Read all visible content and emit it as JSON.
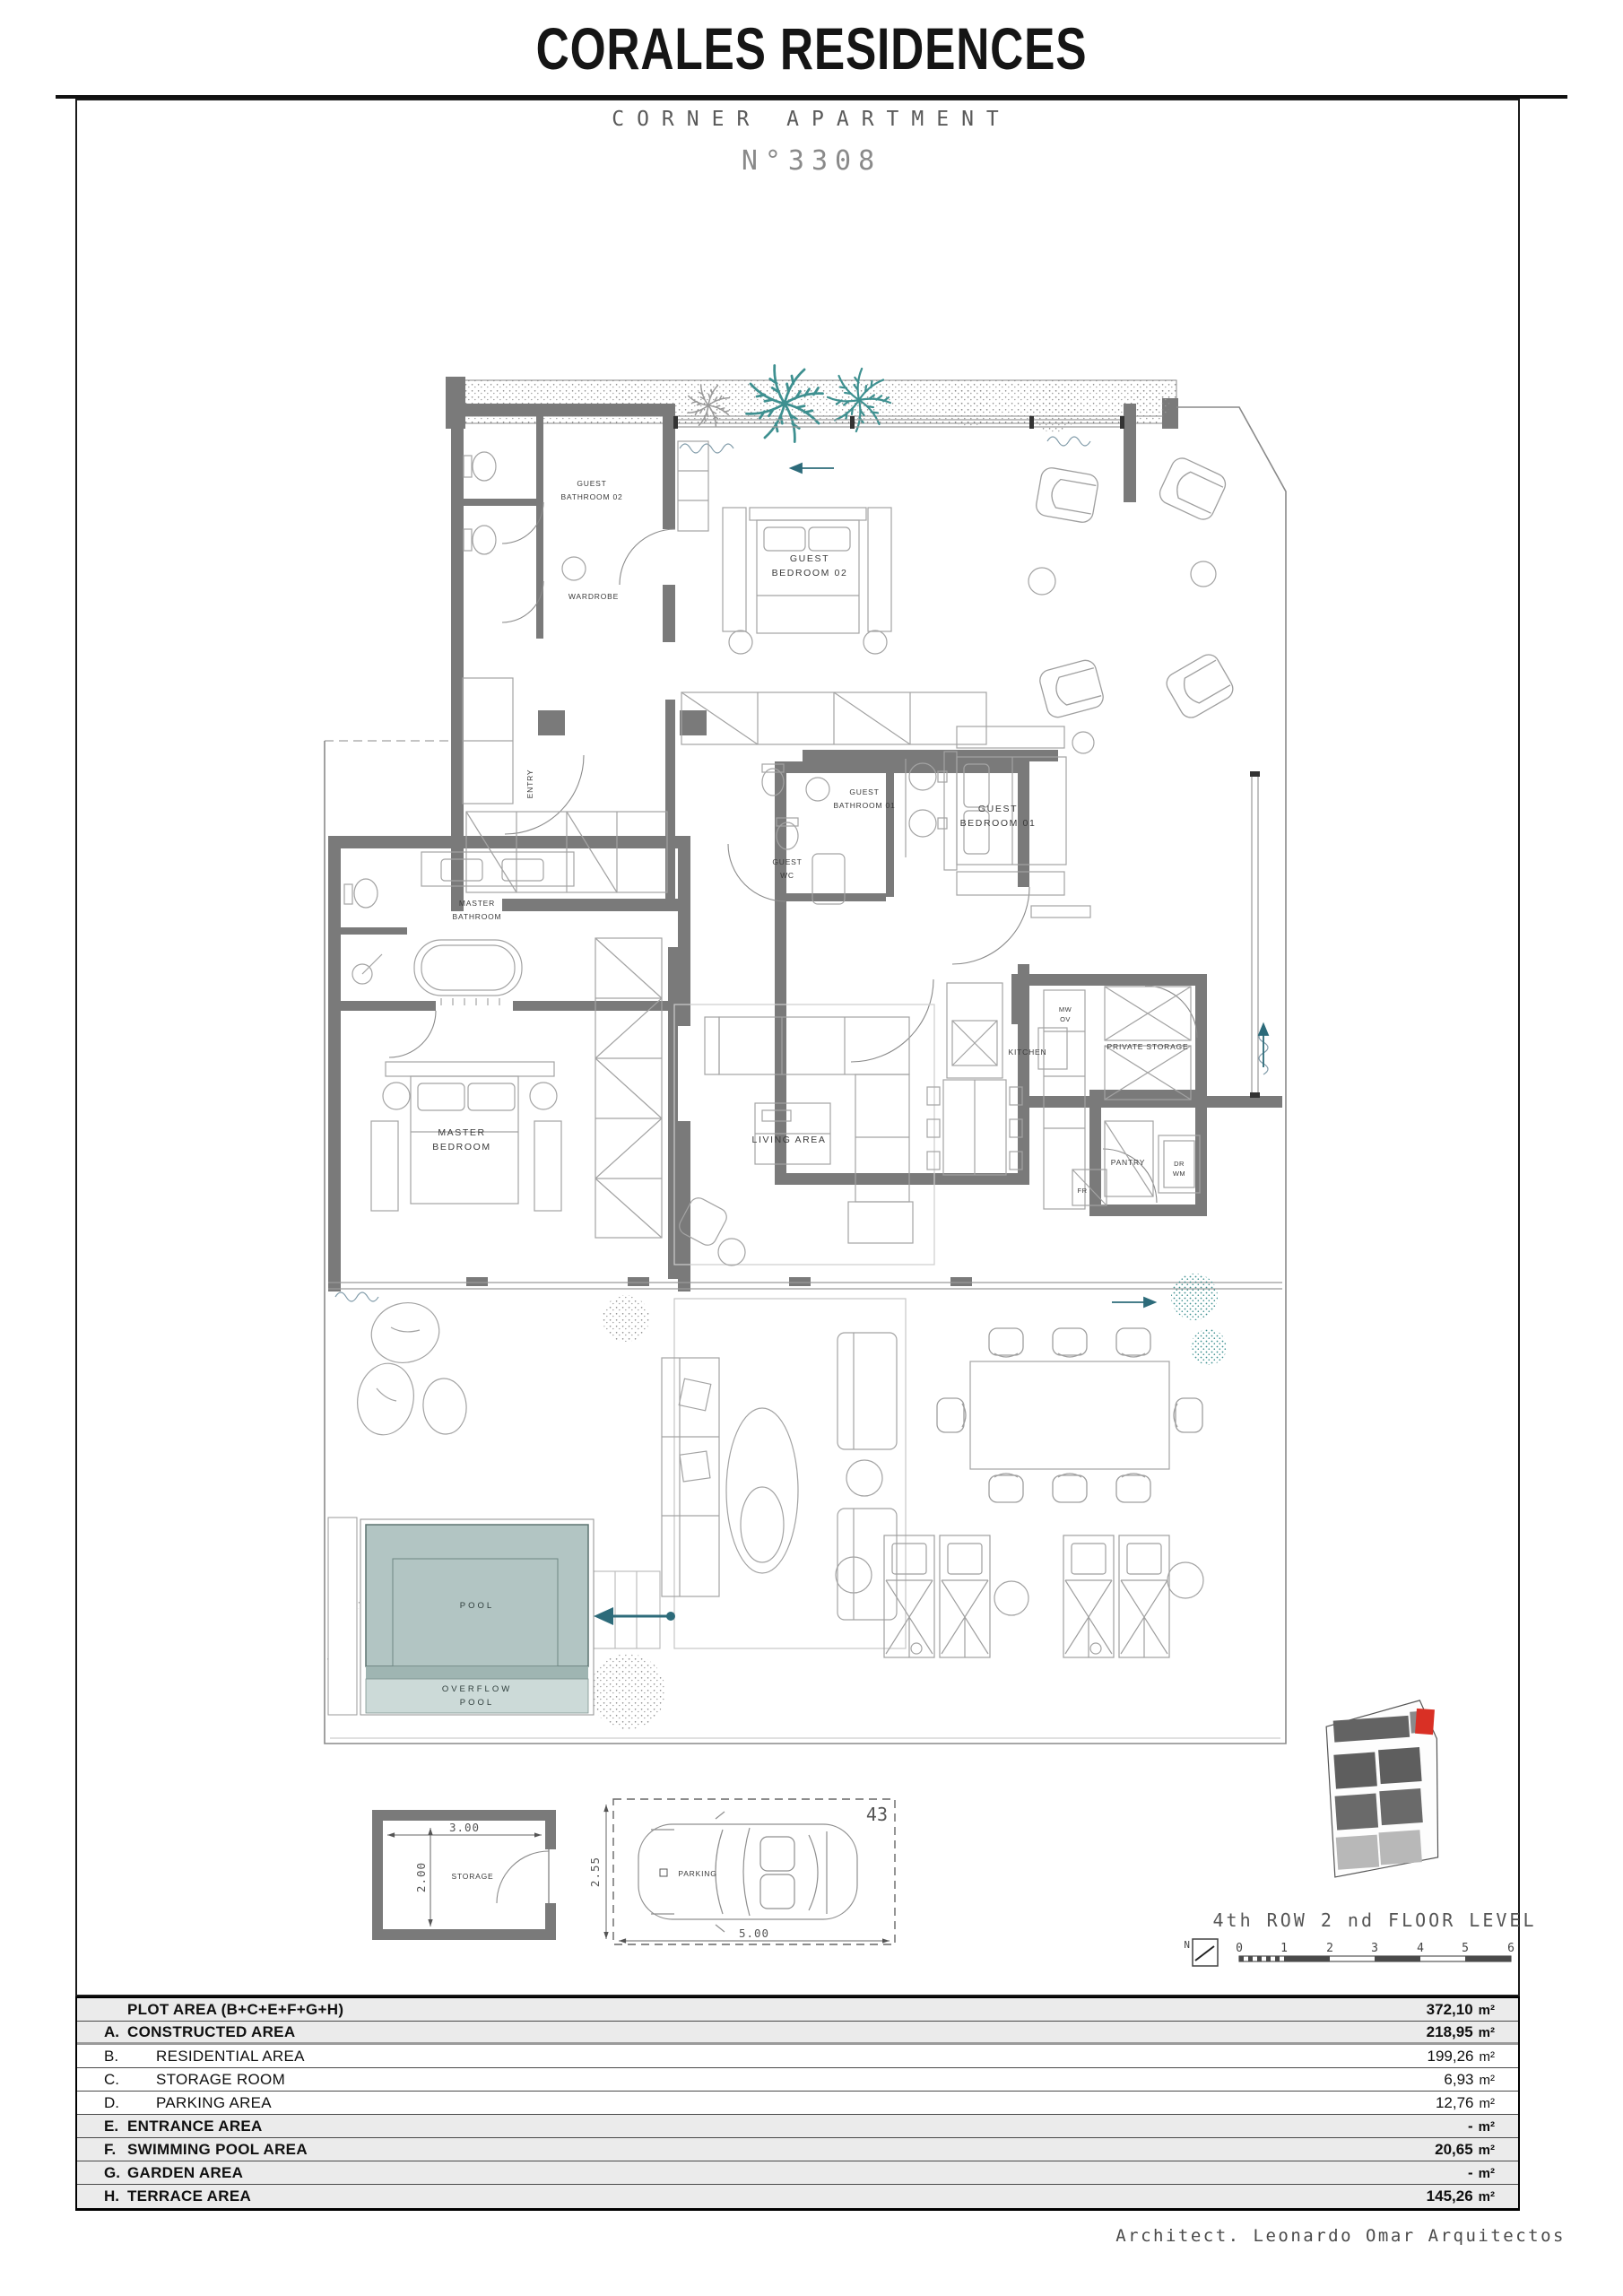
{
  "header": {
    "title": "CORALES RESIDENCES",
    "subtitle": "CORNER APARTMENT",
    "unit_number": "N°3308"
  },
  "plan": {
    "rooms": {
      "guest_bathroom_02": [
        "GUEST",
        "BATHROOM 02"
      ],
      "wardrobe": [
        "WARDROBE"
      ],
      "guest_bedroom_02": [
        "GUEST",
        "BEDROOM 02"
      ],
      "guest_bathroom_01": [
        "GUEST",
        "BATHROOM 01"
      ],
      "guest_wc": [
        "GUEST",
        "WC"
      ],
      "guest_bedroom_01": [
        "GUEST",
        "BEDROOM 01"
      ],
      "master_bathroom": [
        "MASTER",
        "BATHROOM"
      ],
      "master_bedroom": [
        "MASTER",
        "BEDROOM"
      ],
      "living_area": [
        "LIVING AREA"
      ],
      "kitchen": [
        "KITCHEN"
      ],
      "mw_ov": [
        "MW",
        "OV"
      ],
      "private_storage": [
        "PRIVATE STORAGE"
      ],
      "pantry": [
        "PANTRY"
      ],
      "dr_wm": [
        "DR",
        "WM"
      ],
      "fr": [
        "FR"
      ],
      "entry": [
        "ENTRY"
      ],
      "pool": [
        "POOL"
      ],
      "overflow_pool": [
        "OVERFLOW",
        "POOL"
      ]
    }
  },
  "details": {
    "storage": {
      "label": "STORAGE",
      "width_dim": "3.00",
      "height_dim": "2.00"
    },
    "parking": {
      "label": "PARKING",
      "number": "43",
      "width_dim": "5.00",
      "height_dim": "2.55"
    }
  },
  "legend": {
    "floor_level": "4th ROW 2 nd FLOOR LEVEL",
    "north": "N",
    "scale": [
      "0",
      "1",
      "2",
      "3",
      "4",
      "5",
      "6"
    ]
  },
  "area_table": {
    "rows": [
      {
        "letter": "",
        "label": "PLOT AREA (B+C+E+F+G+H)",
        "value": "372,10",
        "unit": "m²"
      },
      {
        "letter": "A.",
        "label": "CONSTRUCTED AREA",
        "value": "218,95",
        "unit": "m²"
      },
      {
        "letter": "B.",
        "label": "RESIDENTIAL AREA",
        "value": "199,26",
        "unit": "m²"
      },
      {
        "letter": "C.",
        "label": "STORAGE ROOM",
        "value": "6,93",
        "unit": "m²"
      },
      {
        "letter": "D.",
        "label": "PARKING AREA",
        "value": "12,76",
        "unit": "m²"
      },
      {
        "letter": "E.",
        "label": "ENTRANCE AREA",
        "value": "-",
        "unit": "m²"
      },
      {
        "letter": "F.",
        "label": "SWIMMING POOL AREA",
        "value": "20,65",
        "unit": "m²"
      },
      {
        "letter": "G.",
        "label": "GARDEN AREA",
        "value": "-",
        "unit": "m²"
      },
      {
        "letter": "H.",
        "label": "TERRACE AREA",
        "value": "145,26",
        "unit": "m²"
      }
    ]
  },
  "footer": {
    "credit": "Architect. Leonardo Omar Arquitectos"
  },
  "colors": {
    "wall_gray": "#7a7a7a",
    "pool_fill": "#b2c5c3",
    "pool_light": "#ccdad8",
    "pool_band": "#9fb5b2",
    "palm_teal": "#3e9090",
    "accent_arrow": "#2d6b7a",
    "unit_red": "#d93025"
  }
}
